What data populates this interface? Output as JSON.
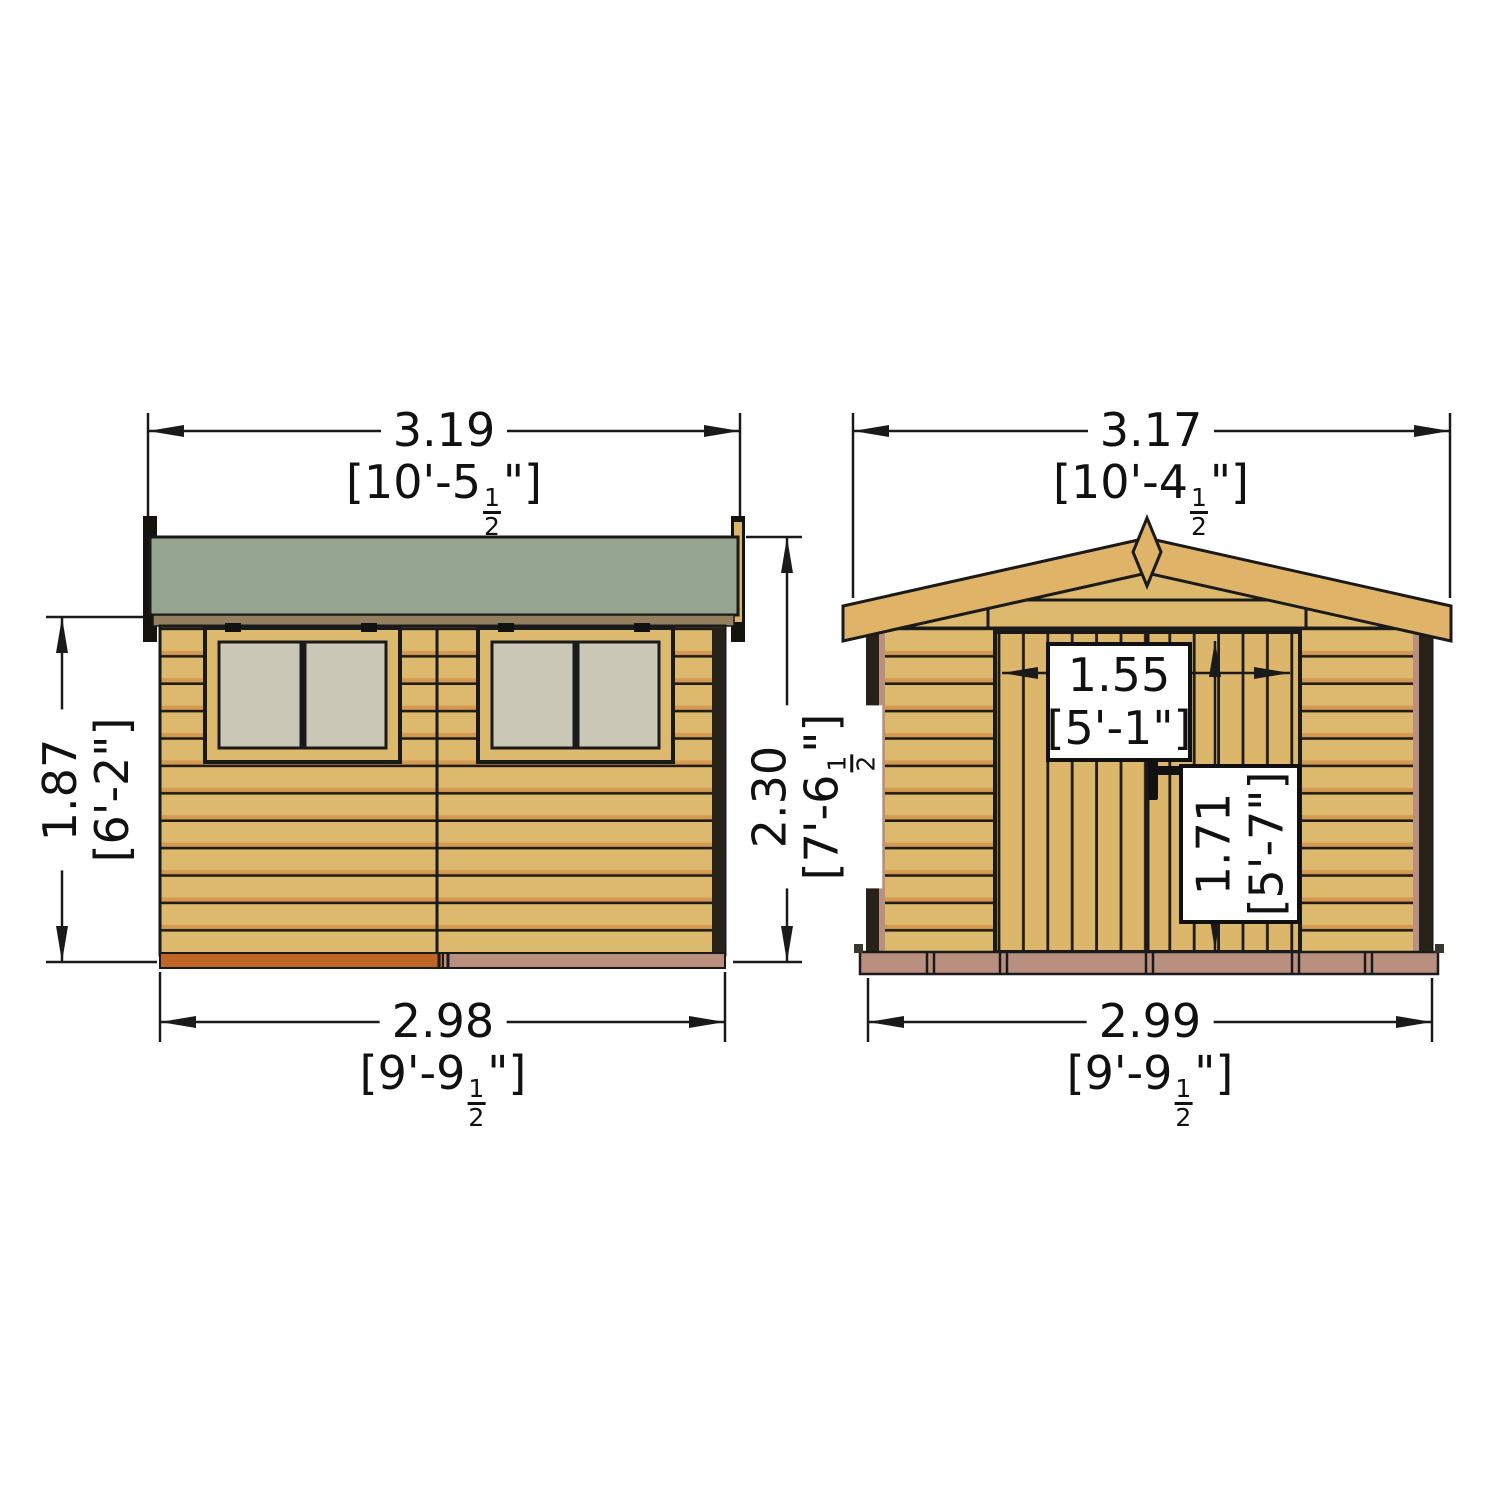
{
  "colors": {
    "background": "#ffffff",
    "line": "#1a1a1a",
    "wall_wood": "#ddb96e",
    "wood_shade": "#d59a50",
    "roof_felt_green": "#95a58f",
    "roof_fascia_wood": "#dfb468",
    "fascia_brown": "#93805f",
    "window_glass": "#cbc7b7",
    "trim_dark": "#262218",
    "base_rust": "#bf6526",
    "base_pink": "#b98f80",
    "label_bg": "#ffffff"
  },
  "dims": {
    "side_top": {
      "m": "3.19",
      "pre": "[10'-5",
      "fn": "1",
      "fd": "2",
      "post": "\"]"
    },
    "side_left": {
      "m": "1.87",
      "pre": "[6'-2\"]",
      "fn": "",
      "fd": "",
      "post": ""
    },
    "side_right": {
      "m": "2.30",
      "pre": "[7'-6",
      "fn": "1",
      "fd": "2",
      "post": "\"]"
    },
    "side_bottom": {
      "m": "2.98",
      "pre": "[9'-9",
      "fn": "1",
      "fd": "2",
      "post": "\"]"
    },
    "front_top": {
      "m": "3.17",
      "pre": "[10'-4",
      "fn": "1",
      "fd": "2",
      "post": "\"]"
    },
    "front_bottom": {
      "m": "2.99",
      "pre": "[9'-9",
      "fn": "1",
      "fd": "2",
      "post": "\"]"
    },
    "door_width": {
      "m": "1.55",
      "pre": "[5'-1\"]",
      "fn": "",
      "fd": "",
      "post": ""
    },
    "door_height": {
      "m": "1.71",
      "pre": "[5'-7\"]",
      "fn": "",
      "fd": "",
      "post": ""
    }
  }
}
